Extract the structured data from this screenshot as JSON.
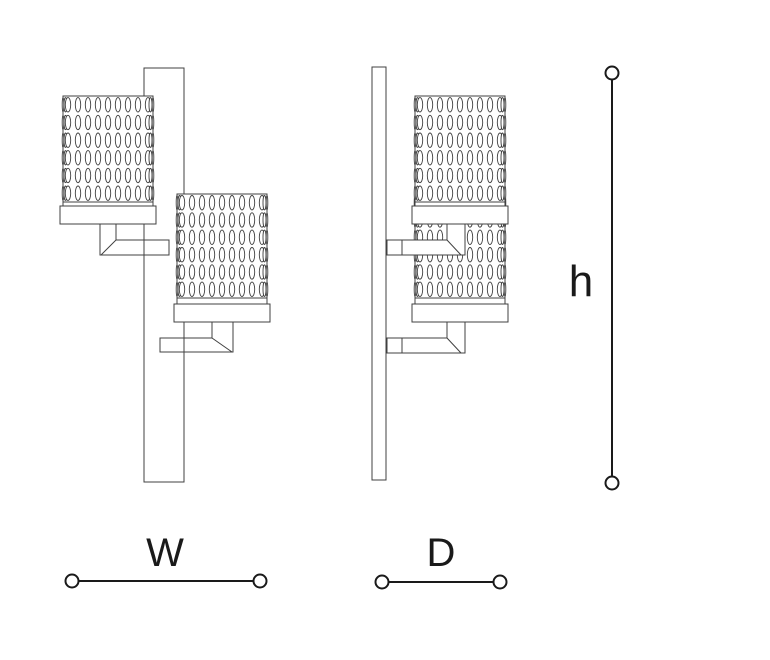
{
  "labels": {
    "width": "W",
    "depth": "D",
    "height": "h"
  },
  "colors": {
    "background": "#ffffff",
    "line": "#404040",
    "dimension": "#1a1a1a"
  }
}
